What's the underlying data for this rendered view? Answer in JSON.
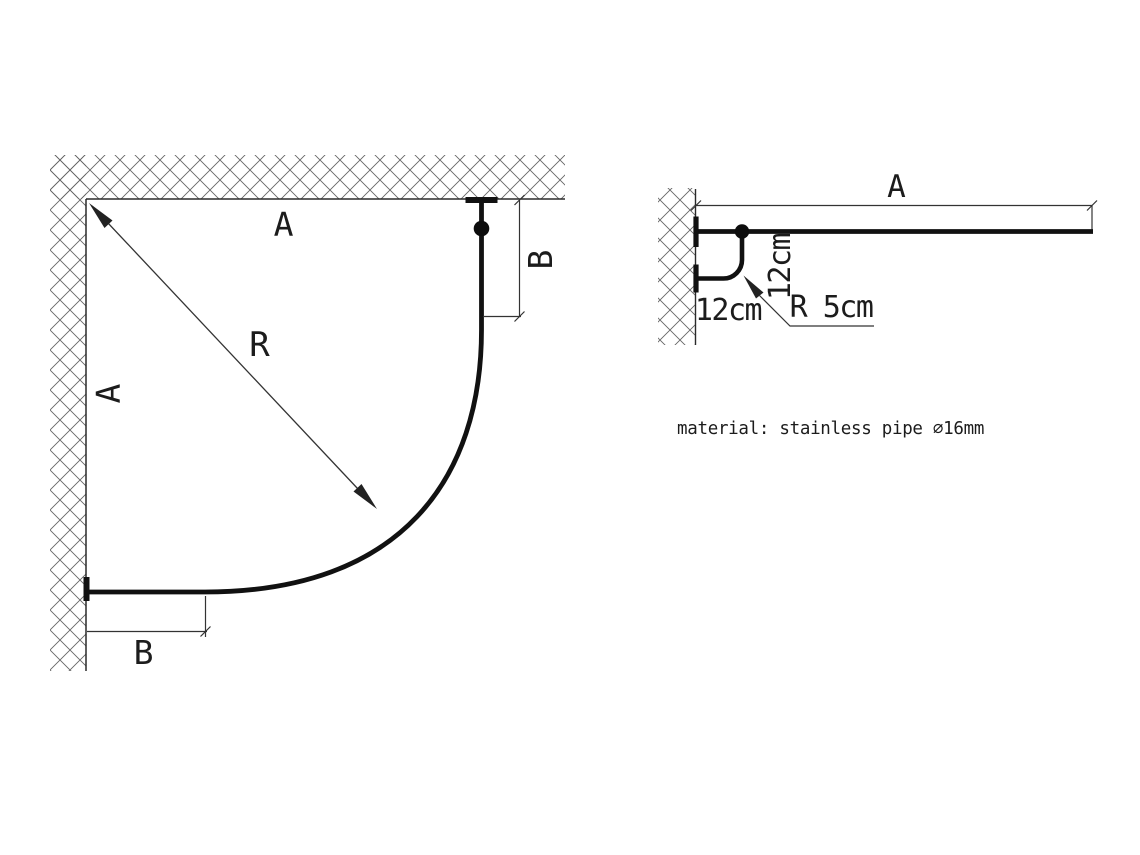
{
  "plan_view": {
    "label_a_top": "A",
    "label_a_left": "A",
    "label_r": "R",
    "label_b_right": "B",
    "label_b_bottom": "B"
  },
  "side_view": {
    "label_a": "A",
    "label_offset_vertical": "12cm",
    "label_offset_horizontal": "12cm",
    "label_radius": "R 5cm"
  },
  "note": {
    "material": "material: stainless pipe ⌀16mm"
  },
  "colors": {
    "background": "#ffffff",
    "drawing_line": "#111111",
    "dimension_line": "#333333",
    "hatch_line": "#666666"
  }
}
